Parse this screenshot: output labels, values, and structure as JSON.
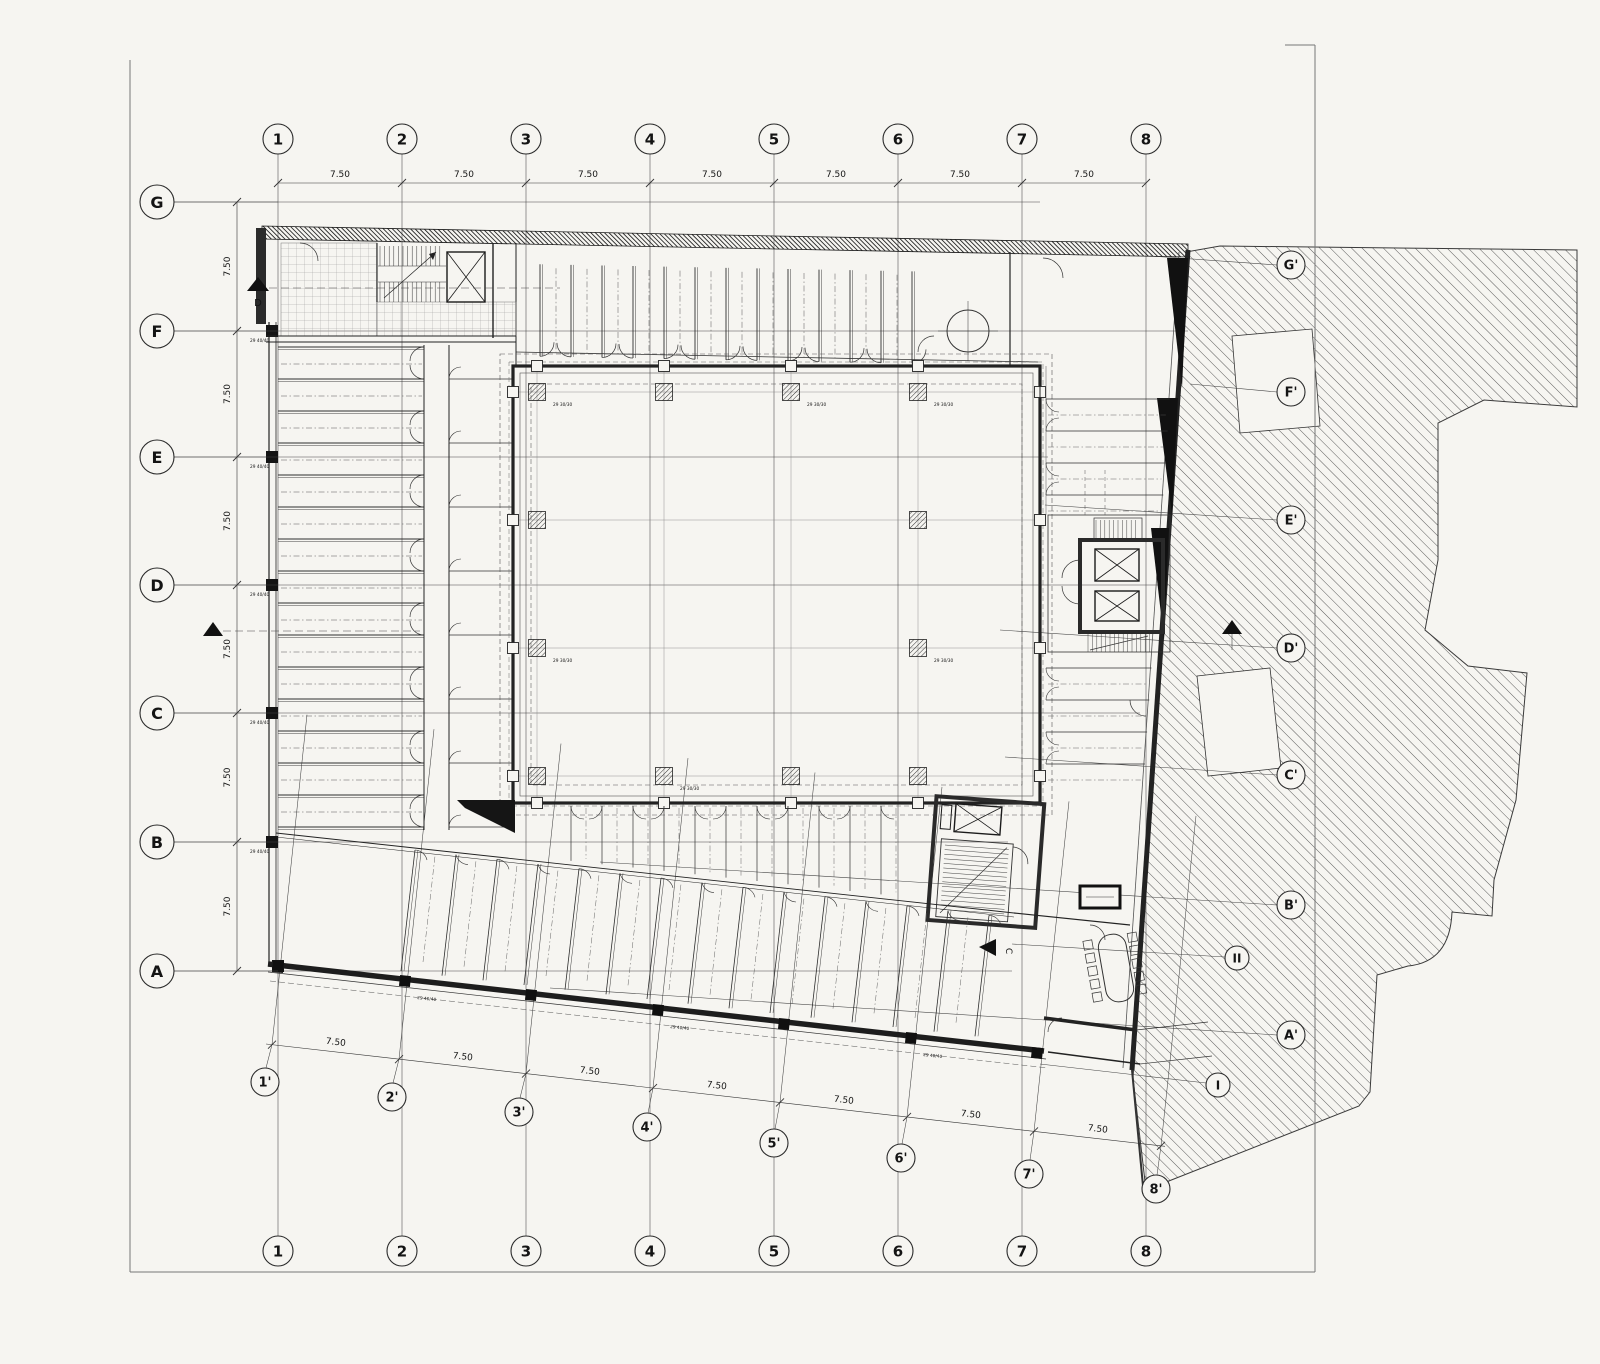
{
  "grid": {
    "columns": [
      "1",
      "2",
      "3",
      "4",
      "5",
      "6",
      "7",
      "8"
    ],
    "rows_left": [
      "G",
      "F",
      "E",
      "D",
      "C",
      "B",
      "A"
    ],
    "rows_right": [
      "G'",
      "F'",
      "E'",
      "D'",
      "C'",
      "B'",
      "A'"
    ],
    "columns_primed": [
      "1'",
      "2'",
      "3'",
      "4'",
      "5'",
      "6'",
      "7'",
      "8'"
    ],
    "site_marks": [
      "II",
      "I"
    ]
  },
  "dimensions": {
    "top": [
      "7.50",
      "7.50",
      "7.50",
      "7.50",
      "7.50",
      "7.50",
      "7.50"
    ],
    "left": [
      "7.50",
      "7.50",
      "7.50",
      "7.50",
      "7.50",
      "7.50"
    ],
    "bottom": [
      "7.50",
      "7.50",
      "7.50",
      "7.50",
      "7.50",
      "7.50",
      "7.50"
    ]
  },
  "section_markers": {
    "top_left": "D",
    "bottom": "C"
  },
  "column_codes": {
    "large": "29 40/40",
    "small": "29 30/30"
  },
  "colors": {
    "ink": "#1f1f1f",
    "paper": "#f6f5f1",
    "hatch": "#4a4a4a"
  }
}
